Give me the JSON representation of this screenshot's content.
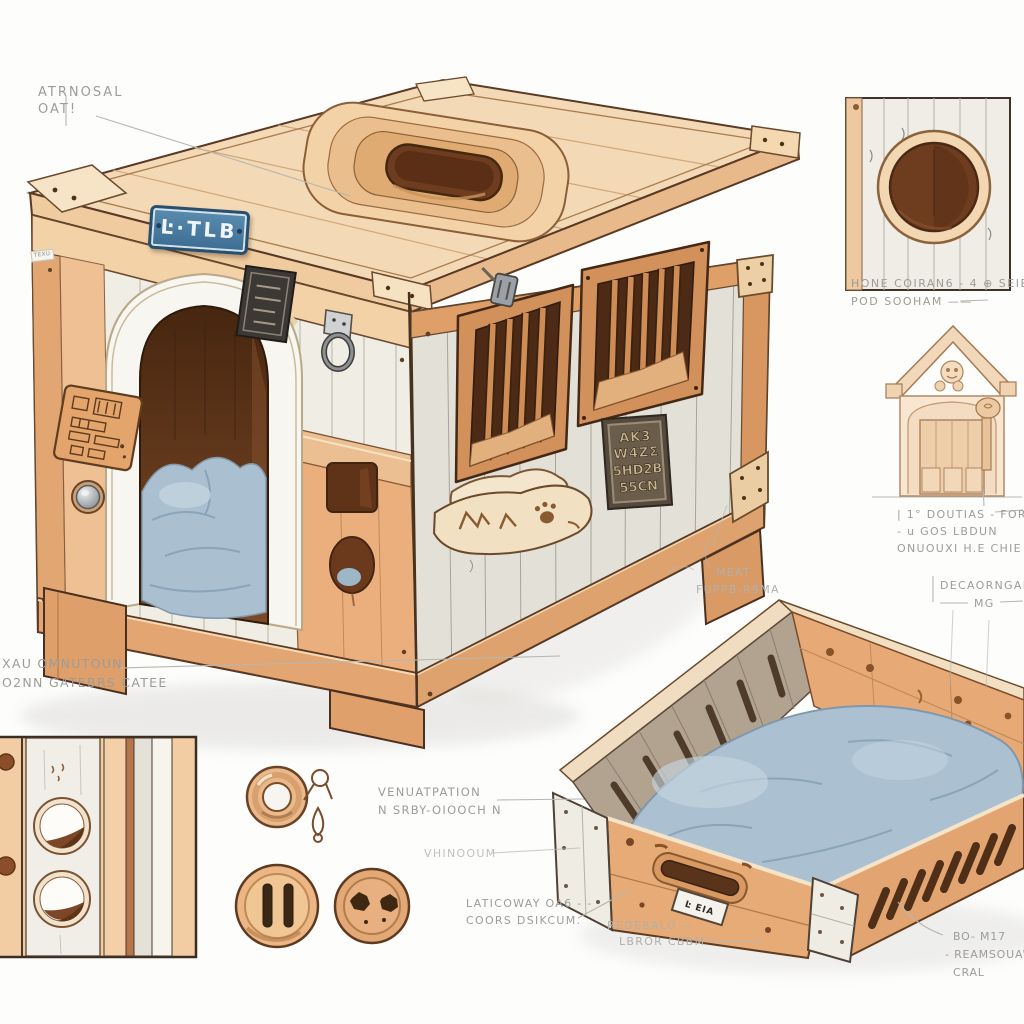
{
  "colors": {
    "accent_wood": "#d98e55",
    "wood_light": "#f4d9b6",
    "plank_white": "#f0ede4",
    "plank_gray": "#e2e0d7",
    "cushion_blue": "#aabfd0",
    "nameplate_blue": "#4e81a8",
    "plaque_dark": "#55493c",
    "pencil_gray": "#9e9c97"
  },
  "nameplate": {
    "text": "Ŀ·TLB"
  },
  "side_tag": {
    "text": "TEXU"
  },
  "metal_plaque": {
    "line1": "AK3",
    "line2": "W4ZΣ",
    "line3": "5HD2B",
    "line4": "55CN"
  },
  "tray_label": {
    "text": "Ŀ EIA"
  },
  "annotations": {
    "top_left": {
      "line1": "ATRNOSAL",
      "line2": "OAT!"
    },
    "left_mid": {
      "line1": "XAU OMNUTOUN",
      "line2": "O2NN GATEBRS CATEE"
    },
    "ventilation": {
      "line1": "VENUATPATION",
      "line2": "N SRBY-OIOOCH N"
    },
    "vhinooum": {
      "line1": "VHINOOUM"
    },
    "laticoway": {
      "line1": "LATICOWAY OA6 - -",
      "line2": "COORS DSIKCUM."
    },
    "redebalo": {
      "line1": "REDEBALO  —",
      "line2": "LBROR CBBM"
    },
    "meat": {
      "line1": "MEAT",
      "line2": "FUPPB-R9MA"
    },
    "hole_detail": {
      "line1": "HONE COIRAN6 - 4   ⊕  SEIE B14",
      "line2": "POD SOOHAM  ——"
    },
    "door_detail": {
      "line1": "| 1° DOUTIAS - FOR  ——",
      "line2": "- u GOS LBDUN",
      "line3": "ONUOUXI H.E CHIE ."
    },
    "decor": {
      "line1": "DECAORNGAIN",
      "line2": "MG"
    },
    "bottom_right": {
      "line1": "BO- M17",
      "line2": "- REAMSOUAWN",
      "line3": "CRAL"
    }
  }
}
